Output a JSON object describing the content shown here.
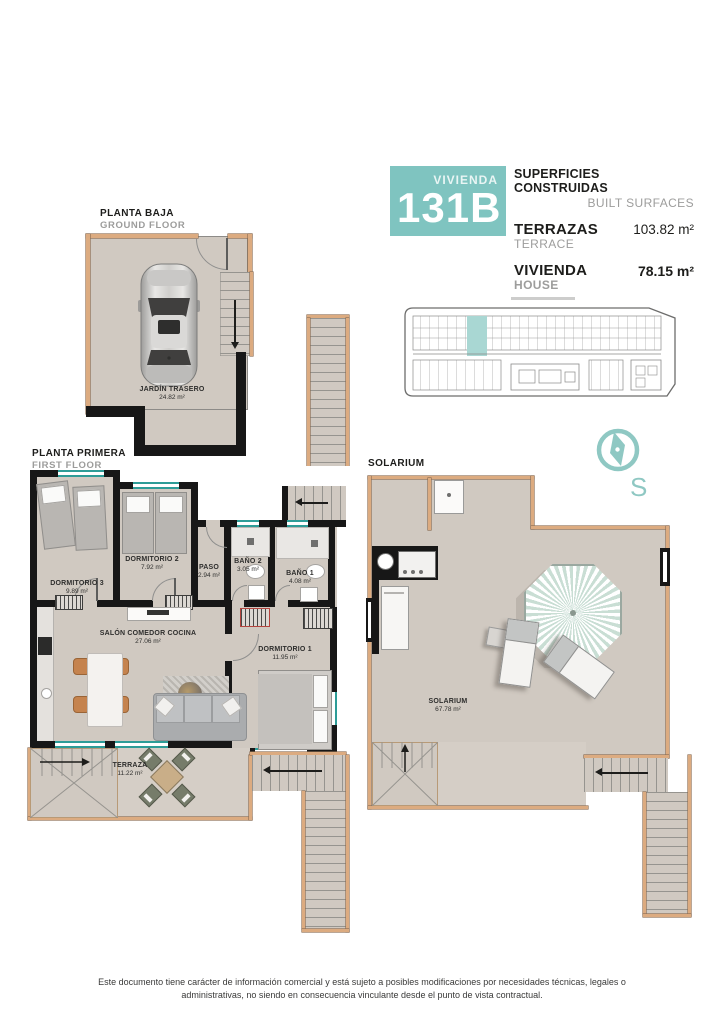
{
  "palette": {
    "accent_teal": "#7fc4c0",
    "window_teal": "#2d9c97",
    "wall_tan": "#dcab80",
    "floor_beige": "#d0c9c1",
    "wall_black": "#171717"
  },
  "header": {
    "unit_label": "VIVIENDA",
    "unit_number": "131B",
    "surfaces_title_es": "SUPERFICIES CONSTRUIDAS",
    "surfaces_title_en": "BUILT SURFACES",
    "rows": [
      {
        "label_es": "TERRAZAS",
        "label_en": "TERRACE",
        "value": "103.82 m²"
      },
      {
        "label_es": "VIVIENDA",
        "label_en": "HOUSE",
        "value": "78.15 m²"
      }
    ]
  },
  "compass": {
    "label": "S"
  },
  "plans": {
    "ground": {
      "title_es": "PLANTA BAJA",
      "title_en": "GROUND FLOOR",
      "rooms": [
        {
          "name": "JARDÍN TRASERO",
          "area": "24.82 m²"
        }
      ]
    },
    "first": {
      "title_es": "PLANTA PRIMERA",
      "title_en": "FIRST FLOOR",
      "rooms": [
        {
          "name": "DORMITORIO 3",
          "area": "9.89 m²"
        },
        {
          "name": "DORMITORIO 2",
          "area": "7.92 m²"
        },
        {
          "name": "PASO",
          "area": "2.94 m²"
        },
        {
          "name": "BAÑO 2",
          "area": "3.05 m²"
        },
        {
          "name": "BAÑO 1",
          "area": "4.08 m²"
        },
        {
          "name": "SALÓN COMEDOR COCINA",
          "area": "27.06 m²"
        },
        {
          "name": "DORMITORIO 1",
          "area": "11.95 m²"
        },
        {
          "name": "TERRAZA",
          "area": "11.22 m²"
        }
      ]
    },
    "solarium": {
      "title": "SOLARIUM",
      "rooms": [
        {
          "name": "SOLARIUM",
          "area": "67.78 m²"
        }
      ]
    }
  },
  "footer": {
    "disclaimer": "Este documento tiene carácter de información comercial y está sujeto a posibles modificaciones por necesidades técnicas, legales o administrativas, no siendo en consecuencia vinculante desde el punto de vista contractual."
  }
}
